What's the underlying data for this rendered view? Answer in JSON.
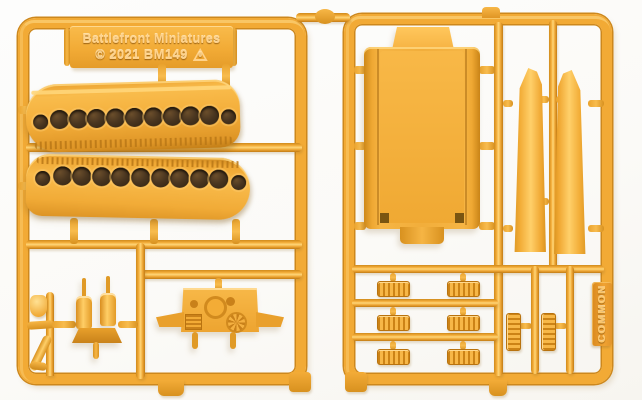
{
  "label_plate": {
    "line1": "Battlefront Miniatures",
    "line2": "© 2021 BM149",
    "recycle_number": "6"
  },
  "side_tab": {
    "text": "COMMON"
  },
  "colors": {
    "plastic_base": "#F2AA35",
    "plastic_highlight": "#FFD678",
    "plastic_shadow": "#CF8A1C",
    "track_hole": "#4A3620",
    "background": "#FBFAF7"
  },
  "tracks": {
    "upper_hole_count": 11,
    "lower_hole_count": 11
  },
  "small_parts": {
    "ribbed_part_rows": 3,
    "ribbed_part_cols": 2,
    "vertical_ribbed_parts": 2
  }
}
